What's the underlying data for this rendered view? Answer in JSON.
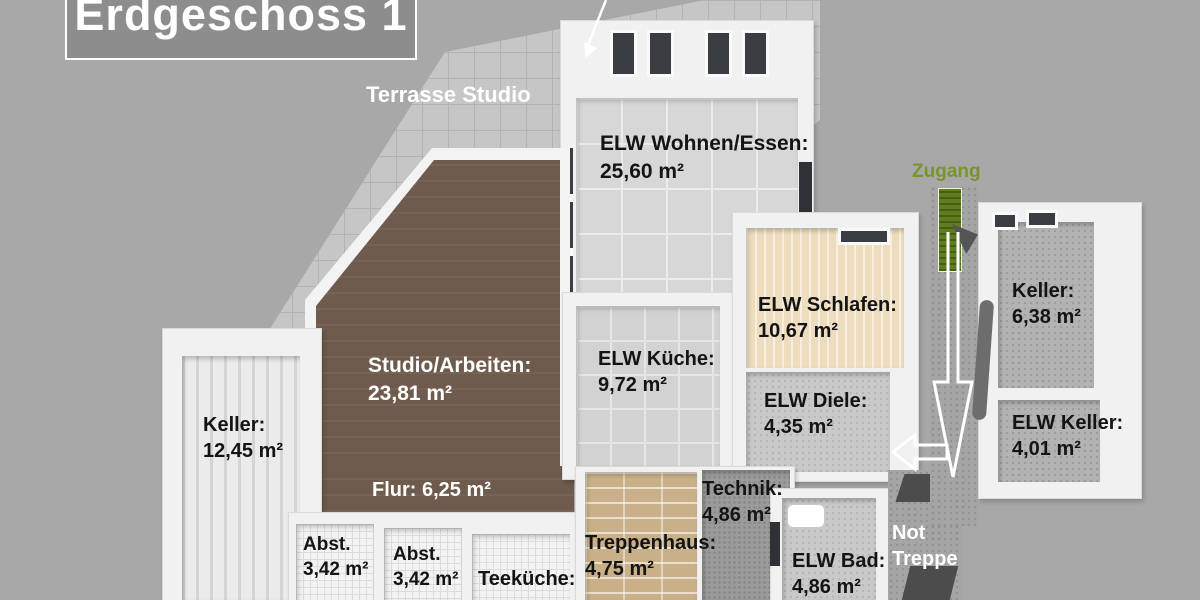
{
  "title": "Erdgeschoss 1",
  "annotations": {
    "terrace_label": "Terrasse Studio",
    "zugang_label": "Zugang",
    "not_treppe_line1": "Not",
    "not_treppe_line2": "Treppe"
  },
  "rooms": {
    "wohnen": {
      "name": "ELW Wohnen/Essen:",
      "area": "25,60 m²"
    },
    "studio": {
      "name": "Studio/Arbeiten:",
      "area": "23,81 m²"
    },
    "kueche": {
      "name": "ELW Küche:",
      "area": "9,72 m²"
    },
    "schlafen": {
      "name": "ELW Schlafen:",
      "area": "10,67 m²"
    },
    "diele": {
      "name": "ELW Diele:",
      "area": "4,35 m²"
    },
    "keller_left": {
      "name": "Keller:",
      "area": "12,45 m²"
    },
    "keller_right": {
      "name": "Keller:",
      "area": "6,38 m²"
    },
    "elw_keller": {
      "name": "ELW Keller:",
      "area": "4,01 m²"
    },
    "flur": {
      "label": "Flur: 6,25 m²"
    },
    "abst1": {
      "name": "Abst.",
      "area": "3,42 m²"
    },
    "abst2": {
      "name": "Abst.",
      "area": "3,42 m²"
    },
    "teekueche": {
      "name": "Teeküche:"
    },
    "treppenhaus": {
      "name": "Treppenhaus:",
      "area": "4,75 m²"
    },
    "technik": {
      "name": "Technik:",
      "area": "4,86 m²"
    },
    "bad": {
      "name": "ELW Bad:",
      "area": "4,86 m²"
    }
  },
  "colors": {
    "background": "#a8a8a8",
    "title_box": "#8d8d8d",
    "accent_green": "#7a942c",
    "floor_brown": "#6e5b4d",
    "floor_beige": "#eddcbd",
    "floor_tan": "#c9b088",
    "window_dark": "#3a3e42",
    "label_black": "#141414",
    "label_white": "#ffffff"
  }
}
